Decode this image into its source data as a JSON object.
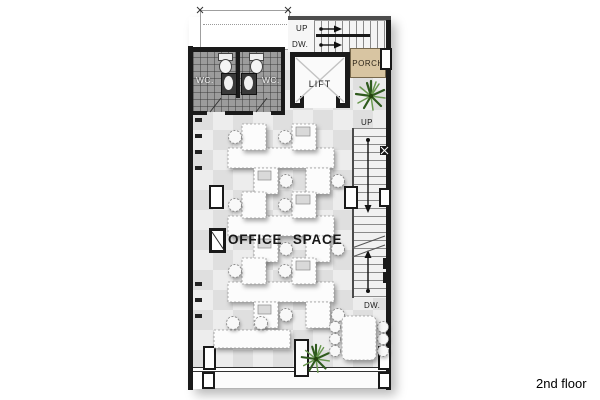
{
  "window": {
    "caption": "2nd floor"
  },
  "plan": {
    "title": "OFFICE SPACE",
    "labels": {
      "top_stair_up": "UP",
      "top_stair_down": "DW.",
      "porch": "PORCH",
      "lift": "LIFT",
      "wc_left": "WC.",
      "wc_right": "WC.",
      "right_stair_up": "UP",
      "right_stair_down": "DW."
    },
    "colors": {
      "wall": "#1a1a1a",
      "floor": "#ededed",
      "floor_alt": "#dfdfdf",
      "wc_floor": "#9c9c9c",
      "porch": "#d8c5a2",
      "porch_text": "#2e2619",
      "plant_dark": "#2f5a1e",
      "plant_light": "#68974e",
      "tread": "#8a8a8a",
      "text": "#1c1c1c",
      "background": "#ffffff"
    }
  }
}
